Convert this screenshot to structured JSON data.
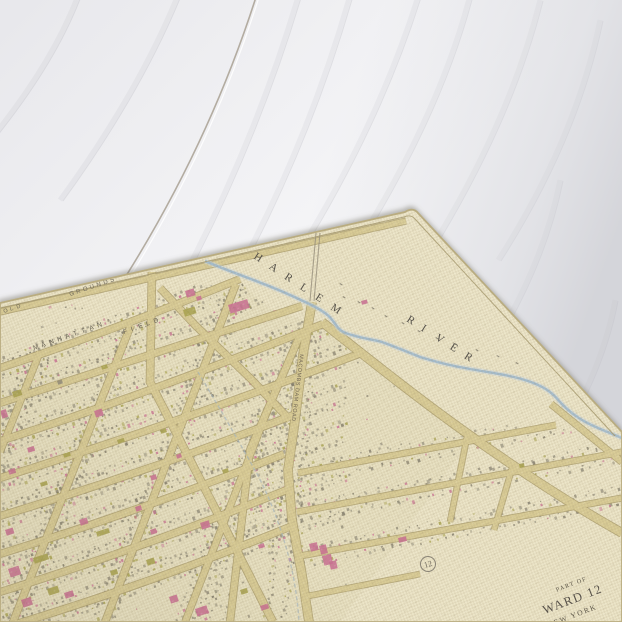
{
  "wood": {
    "base_color": "#f6f6f8",
    "seam": {
      "d": "M257,-6 Q208,148 119,287",
      "highlight_d": "M260,-6 Q212,148 123,288",
      "color": "#b3aca1"
    },
    "grain": [
      "M80,-10 Q55,60 -10,140",
      "M180,-10 Q140,90 60,200",
      "M300,-10 Q250,160 160,320",
      "M350,-5 Q300,170 205,330",
      "M420,-10 Q380,120 300,250",
      "M470,-5 Q440,110 360,240",
      "M540,0 Q510,120 430,250",
      "M600,20 Q575,140 498,260",
      "M560,180 Q540,280 470,380",
      "M615,300 Q600,380 545,460"
    ]
  },
  "map": {
    "palette": {
      "sheet": "#ece5c8",
      "urban": "#e7e0c1",
      "street_fill": "#d9cc96",
      "street_edge": "#ab9e6b",
      "river": "#a3bcce",
      "river_halo": "#c9d8e1",
      "aqueduct": "#9eb3c2",
      "bridge": "#958d7c",
      "neatline": "#a3966a",
      "edge_line": "#b9ac80",
      "pink": "#c96c93",
      "olive": "#a7a24c",
      "gray": "#8f8a79",
      "gray_dark": "#7c7767",
      "ink": "#5d574a"
    },
    "sheet": {
      "outline": "M0,303 L405,212 Q413,207 418,213 L622,432 L622,622 L0,622 Z",
      "neatline": "M0,308 L404,217 Q411,214 415,219 L615,436",
      "urban_region": "M0,372 L243,284 L268,308 L322,326 L470,440 L340,622 L0,622 Z"
    },
    "streets": [
      {
        "name": "edge-road",
        "d": "M0,312 L406,221",
        "w": 5.5
      },
      {
        "name": "cross-street-1",
        "d": "M0,368 Q120,328 240,279",
        "w": 6.5
      },
      {
        "name": "cross-street-2",
        "d": "M0,403 Q140,358 302,306",
        "w": 6.5
      },
      {
        "name": "cross-street-3",
        "d": "M0,441 Q150,393 323,324",
        "w": 6.5
      },
      {
        "name": "cross-street-4",
        "d": "M0,478 Q170,426 364,352",
        "w": 6.5
      },
      {
        "name": "cross-street-5",
        "d": "M0,516 Q150,471 296,414",
        "w": 6.5
      },
      {
        "name": "cross-street-6",
        "d": "M0,554 Q140,511 284,454",
        "w": 6.5
      },
      {
        "name": "cross-street-7",
        "d": "M0,592 Q140,549 289,489",
        "w": 6.5
      },
      {
        "name": "cross-street-8",
        "d": "M0,629 Q150,584 292,526",
        "w": 6.5
      },
      {
        "name": "avenue-1",
        "d": "M40,352 L0,452",
        "w": 6
      },
      {
        "name": "avenue-2",
        "d": "M131,325 L13,622",
        "w": 6.5
      },
      {
        "name": "avenue-3",
        "d": "M236,284 L105,622",
        "w": 6.5
      },
      {
        "name": "avenue-4",
        "d": "M279,381 L185,622",
        "w": 6
      },
      {
        "name": "avenue-5",
        "d": "M301,333 L250,450 L230,622",
        "w": 6.5
      },
      {
        "name": "diagonal-road-west",
        "d": "M152,272 L150,382 L240,557 L273,622",
        "w": 7
      },
      {
        "name": "diagonal-spur",
        "d": "M160,288 L196,326 L250,378 L290,420",
        "w": 6.5
      },
      {
        "name": "macombs-dam-road",
        "d": "M312,302 L303,355 L295,420 L288,470 L292,520 L302,575 L309,622",
        "w": 8
      },
      {
        "name": "diagonal-avenue-east",
        "d": "M322,322 C370,360 420,400 468,434 C510,464 560,498 622,533",
        "w": 8
      },
      {
        "name": "river-road",
        "d": "M551,404 L622,462",
        "w": 6
      },
      {
        "name": "east-row-1",
        "d": "M298,473 L556,425",
        "w": 5.5
      },
      {
        "name": "east-row-2",
        "d": "M297,512 L622,452",
        "w": 5.5
      },
      {
        "name": "east-row-3",
        "d": "M300,556 L622,498",
        "w": 5.5
      },
      {
        "name": "east-row-4",
        "d": "M308,596 L420,574",
        "w": 5
      },
      {
        "name": "east-avenue-1",
        "d": "M468,432 L450,522",
        "w": 5
      },
      {
        "name": "east-avenue-2",
        "d": "M513,465 L494,530",
        "w": 5
      }
    ],
    "river": {
      "d": "M205,261 C235,274 262,282 290,295 C305,302 315,306 322,311 C330,316 332,320 336,325 C340,331 344,333 352,335 C364,339 372,339 382,342 C398,348 408,352 420,357 C436,362 452,366 470,369 C492,373 510,375 528,381 C543,386 552,392 560,402 C572,415 584,422 598,428 L622,438",
      "w": 2.4
    },
    "aqueduct": {
      "d": "M198,372 C215,400 238,440 256,472 C270,497 284,535 292,570 C296,590 298,605 299,622",
      "w": 1.4
    },
    "bridge": {
      "lines": [
        "M316,233 L310,301",
        "M320,233 L314,301"
      ]
    },
    "soundings": [
      [
        343,
        296
      ],
      [
        358,
        301
      ],
      [
        372,
        307
      ],
      [
        385,
        315
      ],
      [
        402,
        322
      ],
      [
        418,
        330
      ],
      [
        436,
        337
      ],
      [
        455,
        343
      ],
      [
        476,
        349
      ],
      [
        340,
        283
      ],
      [
        497,
        355
      ],
      [
        516,
        362
      ]
    ],
    "buildings": [
      [
        228,
        305,
        20,
        9,
        -17,
        "p"
      ],
      [
        185,
        291,
        9,
        7,
        -17,
        "p"
      ],
      [
        183,
        310,
        12,
        7,
        -17,
        "o"
      ],
      [
        196,
        297,
        5,
        4,
        -17,
        "p"
      ],
      [
        361,
        301,
        6,
        4,
        -15,
        "p"
      ],
      [
        12,
        392,
        9,
        6,
        -18,
        "o"
      ],
      [
        0,
        411,
        6,
        8,
        -18,
        "p"
      ],
      [
        94,
        411,
        8,
        7,
        -18,
        "p"
      ],
      [
        27,
        448,
        7,
        5,
        -18,
        "p"
      ],
      [
        63,
        454,
        7,
        4,
        -18,
        "o"
      ],
      [
        117,
        440,
        7,
        4,
        -18,
        "o"
      ],
      [
        8,
        470,
        7,
        5,
        -18,
        "p"
      ],
      [
        40,
        483,
        7,
        4,
        -18,
        "o"
      ],
      [
        150,
        476,
        6,
        5,
        -18,
        "p"
      ],
      [
        135,
        507,
        6,
        5,
        -18,
        "p"
      ],
      [
        5,
        530,
        8,
        6,
        -18,
        "p"
      ],
      [
        8,
        569,
        11,
        9,
        -18,
        "p"
      ],
      [
        21,
        600,
        10,
        8,
        -18,
        "p"
      ],
      [
        79,
        520,
        8,
        6,
        -18,
        "p"
      ],
      [
        33,
        558,
        15,
        6,
        -18,
        "o"
      ],
      [
        47,
        589,
        11,
        7,
        -18,
        "o"
      ],
      [
        96,
        532,
        13,
        5,
        -18,
        "o"
      ],
      [
        146,
        560,
        8,
        6,
        -18,
        "o"
      ],
      [
        64,
        593,
        9,
        6,
        -18,
        "p"
      ],
      [
        169,
        597,
        8,
        7,
        -18,
        "p"
      ],
      [
        195,
        609,
        12,
        8,
        -18,
        "p"
      ],
      [
        200,
        523,
        9,
        7,
        -18,
        "p"
      ],
      [
        309,
        544,
        8,
        8,
        -14,
        "p"
      ],
      [
        319,
        546,
        7,
        9,
        -14,
        "p"
      ],
      [
        322,
        556,
        9,
        10,
        -14,
        "p"
      ],
      [
        329,
        562,
        7,
        8,
        -14,
        "p"
      ],
      [
        398,
        538,
        8,
        5,
        -14,
        "p"
      ],
      [
        519,
        464,
        5,
        4,
        -10,
        "o"
      ],
      [
        101,
        366,
        6,
        4,
        -18,
        "o"
      ],
      [
        57,
        381,
        5,
        4,
        -18,
        "g"
      ],
      [
        160,
        430,
        6,
        4,
        -18,
        "o"
      ],
      [
        176,
        455,
        5,
        4,
        -18,
        "p"
      ],
      [
        222,
        470,
        6,
        4,
        -18,
        "o"
      ],
      [
        150,
        530,
        6,
        5,
        -18,
        "p"
      ],
      [
        110,
        571,
        7,
        5,
        -18,
        "o"
      ],
      [
        240,
        590,
        7,
        5,
        -18,
        "o"
      ],
      [
        258,
        545,
        6,
        4,
        -18,
        "p"
      ],
      [
        260,
        606,
        8,
        5,
        -18,
        "p"
      ]
    ],
    "labels": [
      {
        "name": "label-harlem",
        "text": "HARLEM",
        "mode": "spread",
        "x": 253,
        "y": 258,
        "dx": 15.4,
        "dy": 10.2,
        "rot": 33,
        "size": 11,
        "serif": true,
        "fill": "#55514a"
      },
      {
        "name": "label-river",
        "text": "RIVER",
        "mode": "spread",
        "x": 406,
        "y": 321,
        "dx": 14.4,
        "dy": 9.2,
        "rot": 32,
        "size": 11,
        "serif": true,
        "fill": "#55514a"
      },
      {
        "name": "label-manhattan",
        "text": "MANHATTAN",
        "mode": "spread",
        "x": 34,
        "y": 350,
        "dx": 8.0,
        "dy": -2.8,
        "rot": -19,
        "size": 6.5,
        "serif": false,
        "fill": "#6b6557"
      },
      {
        "name": "label-field",
        "text": "FIELD",
        "mode": "spread",
        "x": 124,
        "y": 334,
        "dx": 7.6,
        "dy": -2.7,
        "rot": -19,
        "size": 6.5,
        "serif": false,
        "fill": "#6b6557"
      },
      {
        "name": "label-grounds",
        "text": "GROUNDS",
        "mode": "spread",
        "x": 70,
        "y": 296,
        "dx": 6.8,
        "dy": -2.3,
        "rot": -17,
        "size": 6,
        "serif": false,
        "fill": "#6b6557"
      },
      {
        "name": "label-old",
        "text": "OLD",
        "mode": "spread",
        "x": 4,
        "y": 313,
        "dx": 6.5,
        "dy": -2.2,
        "rot": -17,
        "size": 5.5,
        "serif": false,
        "fill": "#6b6557"
      },
      {
        "name": "road-label-macombs-dam-road",
        "text": "MACOMBS DAM ROAD",
        "mode": "plain",
        "x": 300,
        "y": 354,
        "rot": 97,
        "size": 5.4,
        "tracking": 0.6,
        "anchor": "start",
        "serif": false,
        "fill": "#6e6453"
      },
      {
        "name": "caption-part-of",
        "text": "PART OF",
        "mode": "plain",
        "x": 572,
        "y": 586,
        "rot": -21,
        "size": 6.2,
        "tracking": 1.2,
        "anchor": "middle",
        "serif": true,
        "fill": "#5f594b"
      },
      {
        "name": "caption-ward",
        "text": "WARD 12",
        "mode": "plain",
        "x": 574,
        "y": 603,
        "rot": -21,
        "size": 12.5,
        "tracking": 1.5,
        "anchor": "middle",
        "serif": true,
        "fill": "#57514a"
      },
      {
        "name": "caption-new-york",
        "text": "NEW YORK",
        "mode": "plain",
        "x": 573,
        "y": 618,
        "rot": -21,
        "size": 7.5,
        "tracking": 1.6,
        "anchor": "middle",
        "serif": true,
        "fill": "#5f594b"
      }
    ],
    "plate_marker": {
      "number": "12",
      "x": 428,
      "y": 564,
      "r": 7.5,
      "rot": -15
    }
  }
}
